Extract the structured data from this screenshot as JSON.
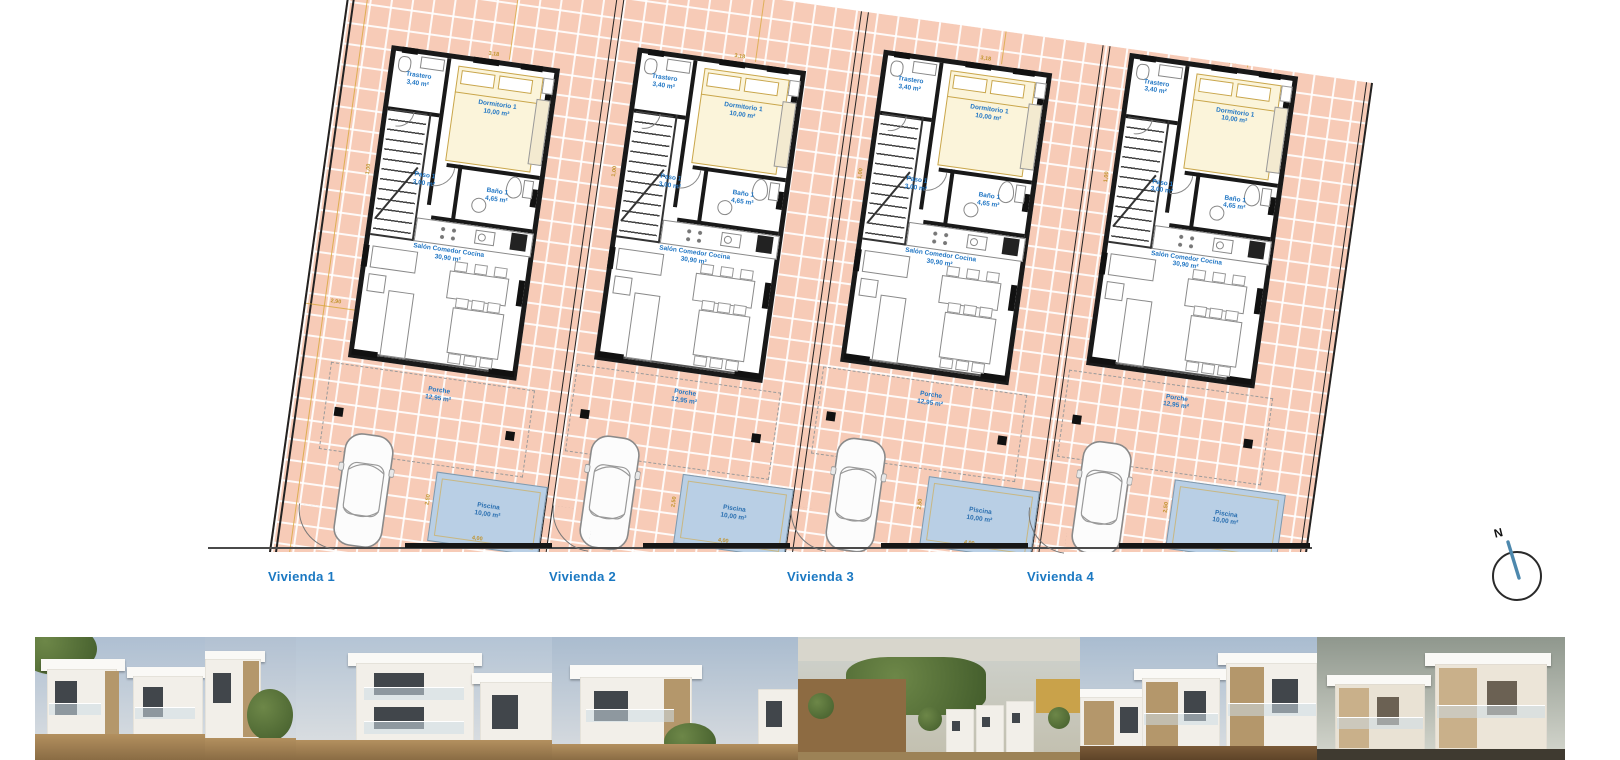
{
  "plan": {
    "rooms": {
      "trastero": {
        "name": "Trastero",
        "area": "3,40 m²"
      },
      "dormitorio": {
        "name": "Dormitorio 1",
        "area": "10,00 m²"
      },
      "paso": {
        "name": "Paso 1",
        "area": "3,00 m²"
      },
      "bano": {
        "name": "Baño 1",
        "area": "4,65 m²"
      },
      "salon": {
        "name": "Salón Comedor Cocina",
        "area": "30,90 m²"
      },
      "porche": {
        "name": "Porche",
        "area": "12,95 m²"
      },
      "piscina": {
        "name": "Piscina",
        "area": "10,00 m²"
      }
    },
    "dims": {
      "dorm_width": "3,18",
      "paso_height": "1,00",
      "pool_width": "4,00",
      "pool_height": "2,50",
      "side_setback": "2,90"
    },
    "units": [
      {
        "label": "Vivienda 1"
      },
      {
        "label": "Vivienda 2"
      },
      {
        "label": "Vivienda 3"
      },
      {
        "label": "Vivienda 4"
      }
    ],
    "compass": {
      "label": "N"
    },
    "colors": {
      "tile": "#f7cbb7",
      "wall": "#1a1a1a",
      "dimension": "#d6a432",
      "room_label": "#2277c4",
      "unit_label": "#1a78c2",
      "pool_fill": "#b9cfe5",
      "pool_border": "#7f99ad"
    }
  },
  "photos": [
    {
      "id": "exterior-villa-1",
      "scene": "villa-day"
    },
    {
      "id": "exterior-villa-2",
      "scene": "villa-day-narrow"
    },
    {
      "id": "exterior-villa-3",
      "scene": "villa-balconies"
    },
    {
      "id": "exterior-villa-4",
      "scene": "villa-corner-palm"
    },
    {
      "id": "aerial-development",
      "scene": "aerial-fields"
    },
    {
      "id": "exterior-rowhouses",
      "scene": "rowhouses-day"
    },
    {
      "id": "exterior-dusk",
      "scene": "rowhouses-dusk"
    }
  ]
}
